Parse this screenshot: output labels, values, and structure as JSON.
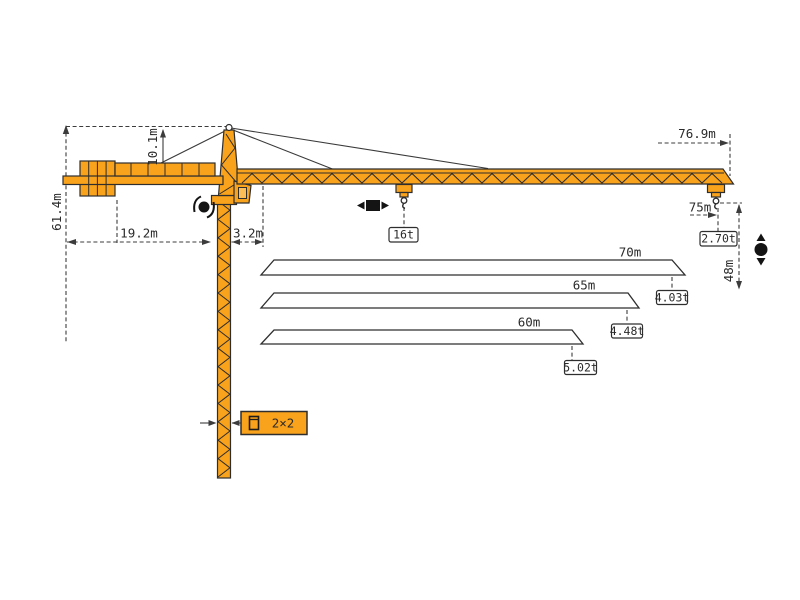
{
  "diagram": {
    "title": "tower-crane-dimension-diagram",
    "colors": {
      "crane_orange": "#F9A21B",
      "outline": "#2e2e2e",
      "dimension_lines": "#3c3c3c",
      "background": "#ffffff"
    },
    "dimensions": {
      "total_height": "61.4m",
      "tower_head_height": "10.1m",
      "counter_jib_radius": "19.2m",
      "jib_foot_offset": "3.2m",
      "max_tip_radius": "76.9m",
      "main_jib_length": "75m",
      "hook_height": "48m",
      "mast_section": "2×2"
    },
    "loads": {
      "max_load": "16t",
      "tip_load_main": "2.70t"
    },
    "jib_options": [
      {
        "length": "70m",
        "tip_load": "4.03t"
      },
      {
        "length": "65m",
        "tip_load": "4.48t"
      },
      {
        "length": "60m",
        "tip_load": "5.02t"
      }
    ],
    "icons": {
      "slewing": "rotation-symbol",
      "trolley_travel": "trolley-travel-symbol",
      "hoisting": "hoist-symbol",
      "mast_section_icon": "section-symbol"
    }
  }
}
